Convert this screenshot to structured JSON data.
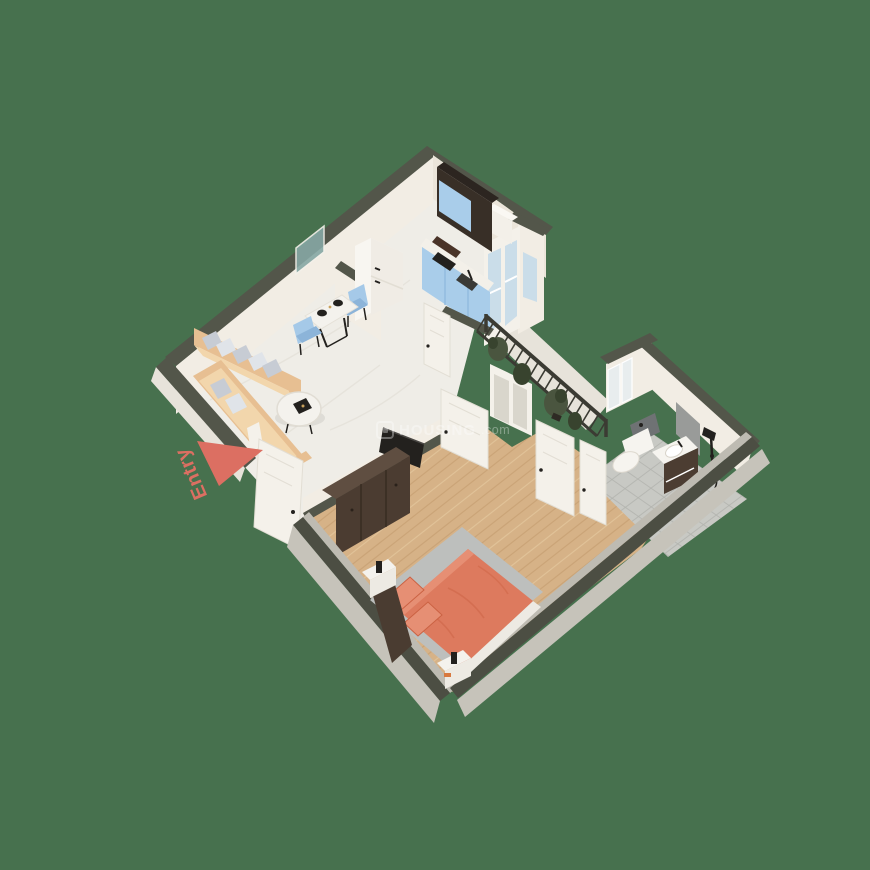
{
  "title": "3D isometric floor plan render (1 BHK apartment)",
  "watermark": {
    "brand": "HOUSING",
    "tld": ".com",
    "logo": "housing-logo"
  },
  "entry": {
    "label": "Entry",
    "arrow": "entry-arrow-triangle"
  },
  "palette": {
    "bg": "#47714E",
    "wallCap": "#53564A",
    "wallCapDark": "#4C4E43",
    "wallFace": "#F2EDE4",
    "wallFaceShadow": "#EBE5DA",
    "wallOuterWhite": "#E7E3DA",
    "wallOuterGray": "#C6C3BA",
    "innerStrip": "#BEBBB2",
    "marble": "#EFEDE7",
    "marbleVein": "#E3E0D8",
    "wood": "#D6B287",
    "woodStripe": "#C29A6C",
    "woodLight": "#E9CFA6",
    "tile": "#C8C9C4",
    "tileLine": "#B2B3AE",
    "railing": "#3B3B33",
    "plant": "#4A553F",
    "plantDark": "#38432E",
    "sofa": "#E7BF92",
    "sofaSeat": "#F2D6AC",
    "pillowGray": "#C7CCD4",
    "pillowLight": "#E0E4E9",
    "chairBlue": "#A5C9E8",
    "chairBlueDark": "#8CB4D9",
    "tableWhite": "#F4F2ED",
    "black": "#23211E",
    "kitchenBlue": "#A9CDEA",
    "kitchenBlueLine": "#8FB9DE",
    "cabinetDark": "#382F27",
    "cabinetDarkTop": "#2C2520",
    "counterWhite": "#F3F0E9",
    "fridgeWhite": "#F0ECE5",
    "fridgeSide": "#F8F6F1",
    "glass": "#CADDE9",
    "doorWhite": "#F4F1EA",
    "doorLine": "#E2DED4",
    "bedCoral": "#DD7A5E",
    "bedCoralDark": "#CB6243",
    "bedCoralLight": "#E68F74",
    "rugGray": "#BDBFBD",
    "headboardBrown": "#4A3C31",
    "dresserBrown": "#4B3C31",
    "dresserTop": "#5F4E41",
    "frameWhite": "#EDEAE3",
    "bathPanelGray": "#999B99",
    "toiletPanel": "#6F7274",
    "vanityBrown": "#4C3D32",
    "fixtureWhite": "#F6F4EF",
    "mirror": "#E8EDEE",
    "artTeal": "#86A8A4",
    "accent": "#DC6F62"
  },
  "rooms": {
    "living_dining": [
      "l-shaped-sofa",
      "gray-pillows",
      "round-coffee-table",
      "dining-table",
      "blue-chairs",
      "black-plates",
      "tv-panel",
      "wall-art"
    ],
    "kitchen": [
      "blue-base-cabinets",
      "dark-upper-cabinet",
      "cooktop",
      "sink",
      "refrigerator",
      "chimney-box",
      "half-wall"
    ],
    "balcony": [
      "iron-railing",
      "plants",
      "glass-enclosure",
      "french-doors"
    ],
    "bedroom": [
      "double-bed-coral",
      "pillows",
      "gray-rug",
      "headboard",
      "dresser",
      "nightstand-left",
      "nightstand-right",
      "wood-floor"
    ],
    "bathroom": [
      "toilet",
      "vanity-sink",
      "shower-set",
      "mirror-panels",
      "marble-panel",
      "gray-tile-floor"
    ],
    "entry": [
      "entry-door",
      "entry-arrow",
      "entry-label"
    ]
  }
}
